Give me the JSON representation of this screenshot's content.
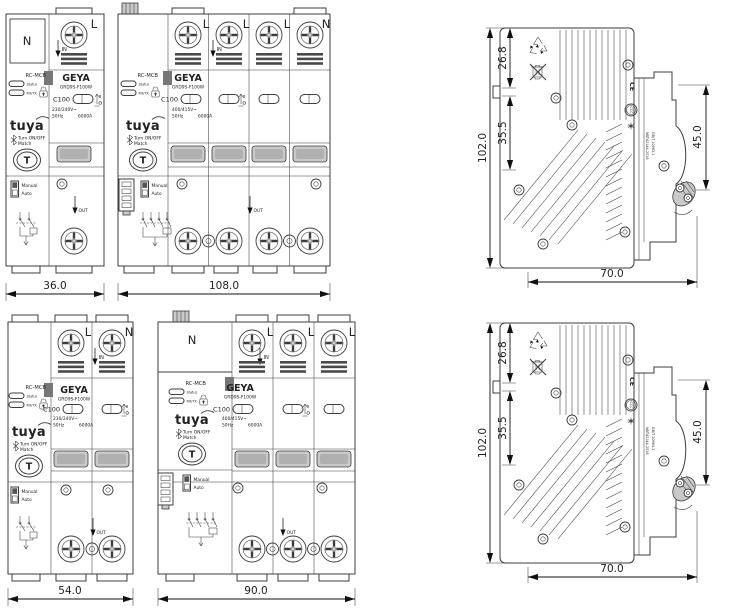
{
  "brand": {
    "logo": "GEYA",
    "tuya_logo": "tuya"
  },
  "labels": {
    "rc_mcb": "RC-MCB",
    "status": "Status",
    "rxtx": "RX/TX",
    "model": "GRD9S-F100W",
    "rating": "C100",
    "voltage_2p": "230/240V~",
    "voltage_4p": "400/415V~",
    "frequency": "50Hz",
    "breaking_capacity": "6000A",
    "terminal_l": "L",
    "terminal_n": "N",
    "in": "IN",
    "out": "OUT",
    "match_line1": "Turn ON/OFF",
    "match_line2": "Match",
    "test_button": "T",
    "manual": "Manual",
    "auto": "Auto"
  },
  "dimensions": {
    "width_2p_compact": "36.0",
    "width_4p_compact": "108.0",
    "width_2p": "54.0",
    "width_4p": "90.0",
    "height": "102.0",
    "top_section": "26.8",
    "mid_section": "35.5",
    "front_depth": "45.0",
    "depth": "70.0"
  },
  "side_view": {
    "ce_mark": "CE",
    "ccc_mark": "CCC",
    "standard_line1": "NBT42144-2018",
    "standard_line2": "GB/T 10963.1"
  }
}
